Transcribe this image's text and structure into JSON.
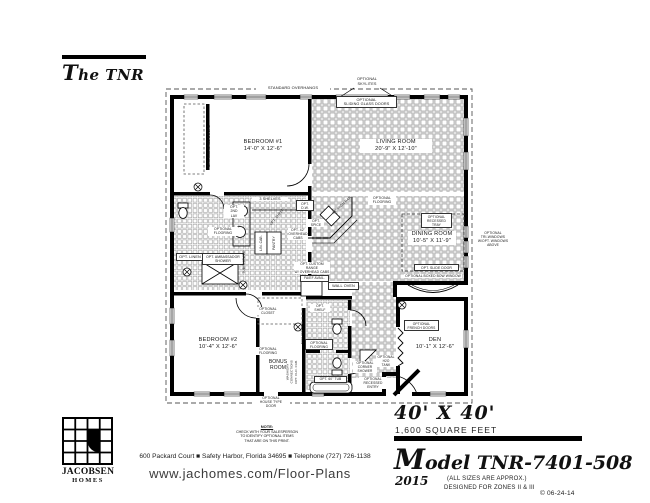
{
  "header": {
    "title": "The TNR"
  },
  "plan": {
    "overhang_label": "STANDARD OVERHANGS",
    "rooms": {
      "bedroom1": "BEDROOM #1\n14'-0\" X 12'-6\"",
      "living": "LIVING ROOM\n20'-9\" X 12'-10\"",
      "dining": "DINING ROOM\n10'-5\" X 11'-9\"",
      "bedroom2": "BEDROOM #2\n10'-4\" X 12'-6\"",
      "den": "DEN\n10'-1\" X 12'-6\"",
      "bonus": "BONUS\nROOM"
    },
    "labels": {
      "skylites": "OPTIONAL\nSKYLITES",
      "sliding_doors": "OPTIONAL\nSLIDING GLASS DOORS",
      "mirrored_doors": "OPT. MIRRORED DOORS",
      "shelves3": "3 SHELVES",
      "second_lav": "OPT.\n2ND\nLAV",
      "flooring_bath1": "OPTIONAL\nFLOORING",
      "linen": "OPT. LINEN",
      "ambassador": "OPT. AMBASSADOR\nSHOWER",
      "tub_shower": "TUB/SHOWER",
      "lin_cab": "LIN. CAB.",
      "pantry": "PANTRY",
      "shelf_diag": "OPT. SHELF",
      "dishwasher": "OPT.\nD.W.",
      "high_bar": "64\" HIGH BAR",
      "spice": "OPT.\nSPICE",
      "overhead_cabs": "OPT. 42\"\nOVERHEAD\nCABS",
      "custom_range": "OPT. CUSTOM RANGE\nW/ OVERHEAD CABS",
      "fa_ef": "FA/EF AVAIL.",
      "wall_oven": "WALL OVEN",
      "flooring_kitchen": "OPTIONAL\nFLOORING",
      "recessed_tray": "OPTIONAL\nRECESSED\nTRAY",
      "slide_door": "OPT. SLIDE DOOR",
      "bow_window": "OPTIONAL BOXED BOW WINDOW",
      "tri_windows": "OPTIONAL\nTRI-WINDOWS\nW/OPT. WINDOWS\nABOVE",
      "closet_bed2": "OPTIONAL\nCLOSET",
      "flooring_bed2": "OPTIONAL\nFLOORING",
      "wash_dry": "WASH/DRY\nCONNECTIONS",
      "clo_cab": "OPT. CLO. CAB.",
      "shelves_v": "SHELVES",
      "house_door": "OPTIONAL\nHOUSE TYPE\nDOOR",
      "shelf_bath2": "OPT.\nSHELF",
      "flooring_bath2": "OPTIONAL\nFLOORING",
      "tub60": "OPT. 60\" TUB",
      "corner_shower": "OPTIONAL\nCORNER\nSHOWER",
      "h2o_tank": "OPTIONAL\nH2O\nTANK",
      "recessed_entry": "OPTIONAL\nRECESSED\nENTRY",
      "french_doors": "OPTIONAL\nFRENCH DOORS"
    }
  },
  "footer": {
    "logo_line1": "JACOBSEN",
    "logo_line2": "HOMES",
    "note_title": "NOTE:",
    "note_body": "CHECK WITH YOUR SALESPERSON\nTO IDENTIFY OPTIONAL ITEMS\nTHAT ARE ON THIS PRINT.",
    "address": "600 Packard Court ■ Safety Harbor, Florida 34695 ■ Telephone (727) 726-1138",
    "website": "www.jachomes.com/Floor-Plans",
    "size": "40' X 40'",
    "sqft": "1,600 SQUARE FEET",
    "model": "Model TNR-7401-508",
    "year": "2015",
    "approx": "(ALL SIZES ARE APPROX.)",
    "zones": "DESIGNED FOR ZONES II & III",
    "copyright": "© 06-24-14"
  }
}
